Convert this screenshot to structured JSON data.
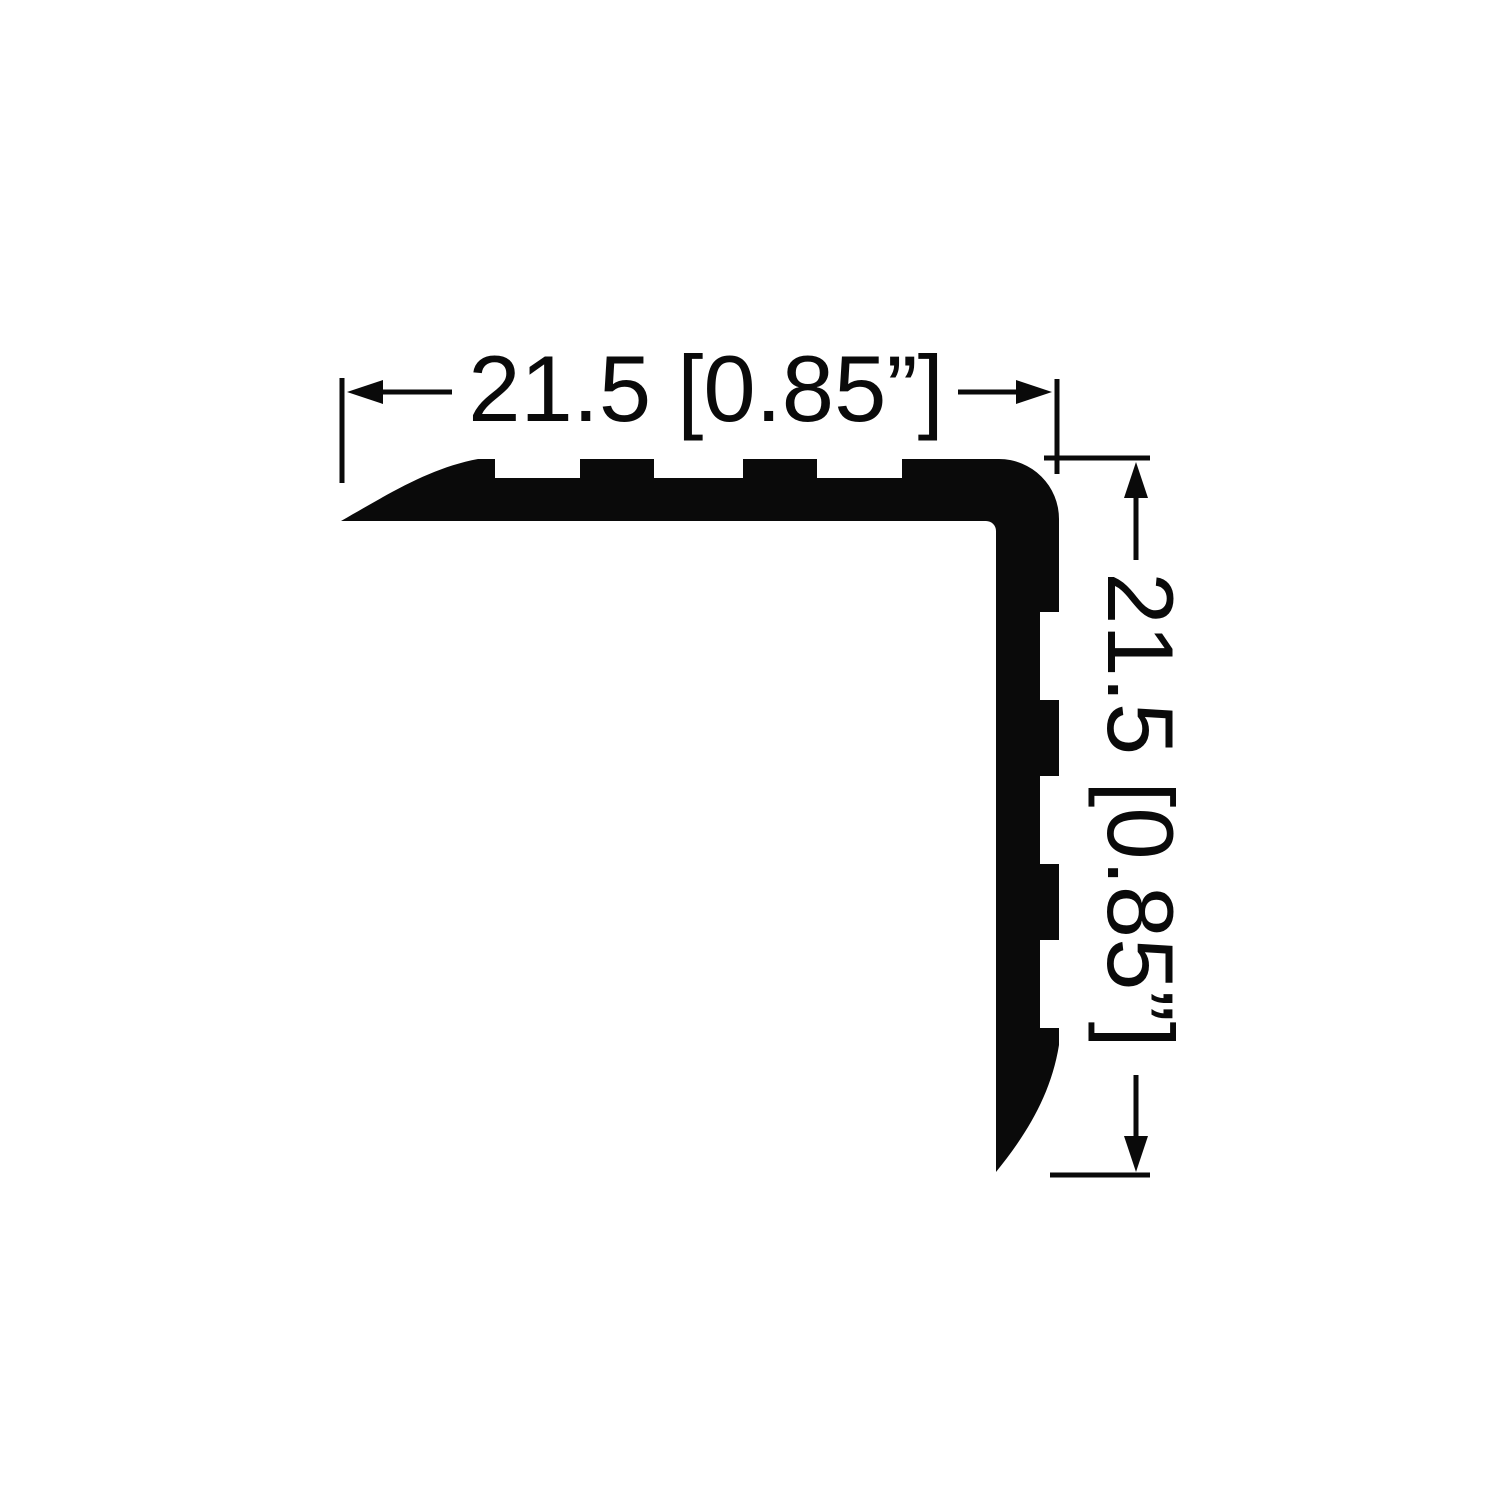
{
  "page": {
    "background_color": "#ffffff",
    "ink_color": "#0a0a0a"
  },
  "drawing": {
    "subject": "L-shaped angle profile cross-section with serrated inner faces and rounded bullnose corner",
    "dimensions": {
      "horizontal": {
        "label": "21.5 [0.85”]",
        "value_mm": "21.5",
        "value_inches": "0.85”"
      },
      "vertical": {
        "label": "21.5 [0.85”]",
        "value_mm": "21.5",
        "value_inches": "0.85”"
      }
    },
    "dimension_style": {
      "arrowheads": [
        "left",
        "right",
        "up",
        "down"
      ],
      "line_color": "#0a0a0a"
    }
  }
}
